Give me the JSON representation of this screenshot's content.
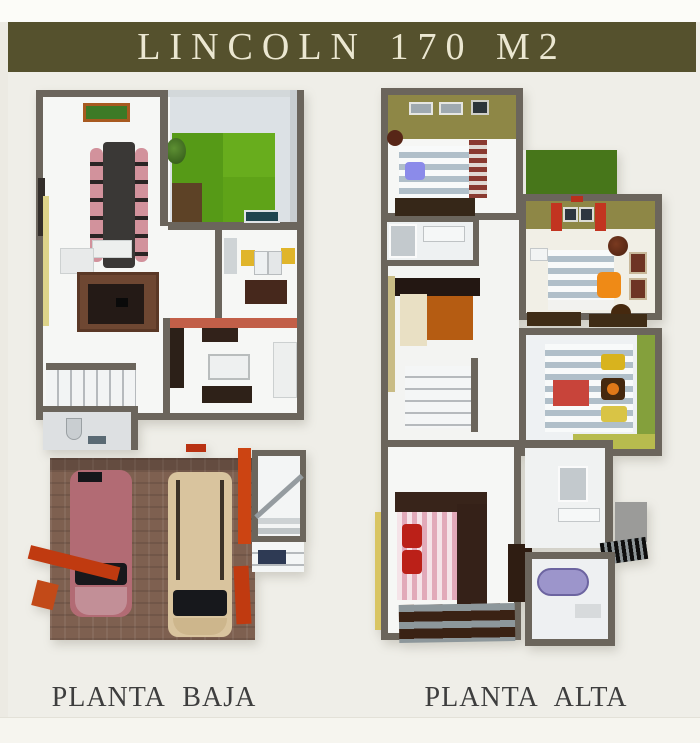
{
  "header": {
    "title": "LINCOLN 170 M2"
  },
  "plans": [
    {
      "label": "PLANTA BAJA"
    },
    {
      "label": "PLANTA ALTA"
    }
  ],
  "palette": {
    "page-bg": "#efeee8",
    "top-strip": "#fcfcf8",
    "left-strip": "#eceae3",
    "bottom-strip": "#f6f5ef",
    "banner-bg": "#55512d",
    "banner-text": "#ebe7d1",
    "label-text": "#3e3e3e",
    "wall": "#6b655c",
    "floor": "#f6f7f5",
    "patio-floor": "#dce1e5",
    "grass": "#569a17",
    "grass-light": "#68ad1d",
    "soil": "#5d4226",
    "brick": "#7e6050",
    "car-pink": "#b26b74",
    "van-beige": "#d9c49e",
    "glass": "#17181c",
    "accent-red": "#c03a10",
    "salmon": "#c25f48",
    "olive": "#8e8746",
    "roof-green": "#47761a",
    "green-wall": "#84a03c",
    "yellow-wall": "#d9c563",
    "counter-yellow": "#e0b52a",
    "pillow-blue": "#8b8bea",
    "pillow-orange": "#ef8a16",
    "pillow-yellow": "#d8b31e",
    "pillow-red": "#bb2018",
    "chair-pink": "#d2929c",
    "sofa-orange": "#b55c12",
    "rug-red": "#c8443a",
    "tub-lavender": "#9c95cb",
    "wood-dark": "#362718"
  }
}
